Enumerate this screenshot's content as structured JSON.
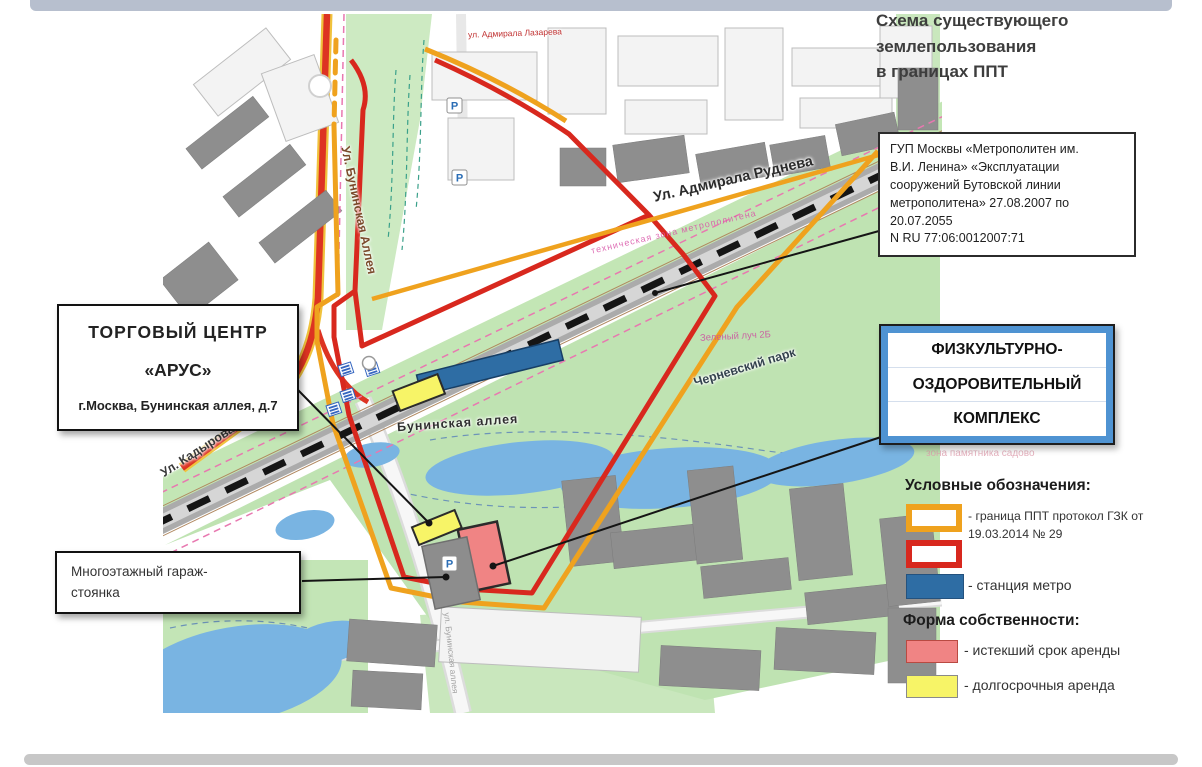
{
  "title": {
    "lines": [
      "Схема существующего",
      "землепользования",
      "в границах ППТ"
    ]
  },
  "info_box": {
    "lines": [
      "ГУП Москвы «Метрополитен им.",
      "В.И. Ленина» «Эксплуатации",
      "сооружений Бутовской линии",
      "метрополитена» 27.08.2007 по",
      "20.07.2055",
      "N RU 77:06:0012007:71"
    ]
  },
  "callout_shopping": {
    "line1": "ТОРГОВЫЙ  ЦЕНТР",
    "line2": "«АРУС»",
    "line3": "г.Москва, Бунинская аллея, д.7"
  },
  "callout_garage": {
    "line1": "Многоэтажный гараж-",
    "line2": "стоянка"
  },
  "callout_fok": {
    "lines": [
      "ФИЗКУЛЬТУРНО-",
      "ОЗДОРОВИТЕЛЬНЫЙ",
      "КОМПЛЕКС"
    ]
  },
  "legend": {
    "title": "Условные обозначения:",
    "boundary_ppt_label": "- граница ППТ протокол ГЗК от 19.03.2014 № 29",
    "metro_station_label": "- станция метро",
    "ownership_title": "Форма собственности:",
    "expired_lease_label": "- истекший срок аренды",
    "longterm_lease_label": "- долгосрочныя аренда",
    "colors": {
      "boundary_ppt": "#efa21e",
      "boundary_red": "#d8281e",
      "metro_blue": "#2e6da4",
      "expired_pink": "#f08484",
      "longterm_yellow": "#f7f467"
    }
  },
  "map": {
    "street_buninskaya": "Ул. Бунинская Аллея",
    "street_rudneva": "Ул. Адмирала Руднева",
    "street_kadyrova": "Ул. Кадырова",
    "street_lazareva": "ул. Адмирала Лазарева",
    "station_name": "Бунинская аллея",
    "park_name": "Черневский парк",
    "tech_zone": "техническая зона метрополитена",
    "green_ray": "Зеленый луч 2Б",
    "sadovo_zone": "зона памятника садово",
    "street_south": "ул. Бунинская аллея",
    "parking_letter": "P"
  }
}
